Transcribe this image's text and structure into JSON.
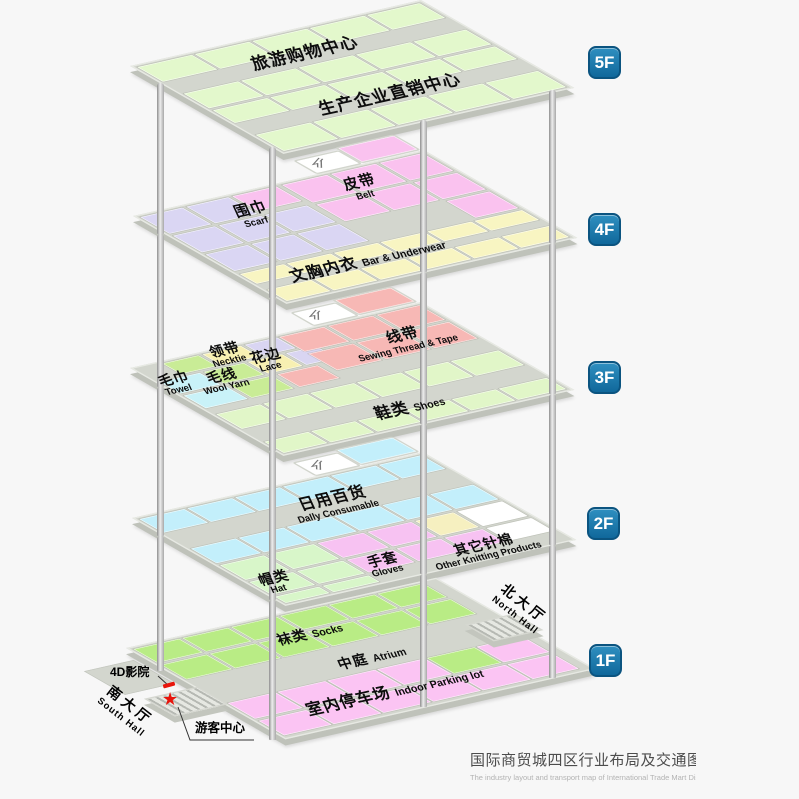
{
  "title": {
    "zh": "国际商贸城四区行业布局及交通图",
    "en": "The industry layout and transport map of International Trade Mart District Four"
  },
  "palette": {
    "base": "#d3d6ce",
    "green5": "#e3f8cc",
    "scarf": "#dad6f3",
    "belt": "#fac2ef",
    "bra": "#f8f5c2",
    "towel": "#c9f2f8",
    "necktie": "#f7f0b2",
    "wool": "#c9ec96",
    "lace": "#d9d5f2",
    "sewing": "#f7b8b5",
    "shoes": "#e1f6c8",
    "daily": "#c3effb",
    "hat": "#d8f6c9",
    "gloves": "#f7c2f2",
    "knitw": "#ffffff",
    "knity": "#f6f0c0",
    "socks": "#b9ec85",
    "parking": "#fbc4f3",
    "white": "#ffffff",
    "badge_blue": "#1879ae",
    "marker_red": "#e8150c"
  },
  "floor_badges": [
    {
      "label": "5F",
      "x": 588,
      "y": 46
    },
    {
      "label": "4F",
      "x": 588,
      "y": 213
    },
    {
      "label": "3F",
      "x": 588,
      "y": 361
    },
    {
      "label": "2F",
      "x": 587,
      "y": 507
    },
    {
      "label": "1F",
      "x": 589,
      "y": 644
    }
  ],
  "floors": [
    {
      "id": "5f",
      "anchor": [
        130,
        66
      ],
      "size": [
        300,
        175
      ],
      "tiles": [
        [
          2,
          2,
          57,
          30,
          "green5"
        ],
        [
          62,
          2,
          57,
          30,
          "green5"
        ],
        [
          122,
          2,
          57,
          30,
          "green5"
        ],
        [
          182,
          2,
          57,
          30,
          "green5"
        ],
        [
          242,
          2,
          55,
          30,
          "green5"
        ],
        [
          2,
          56,
          57,
          30,
          "green5"
        ],
        [
          62,
          56,
          57,
          30,
          "green5"
        ],
        [
          122,
          56,
          57,
          30,
          "green5"
        ],
        [
          182,
          56,
          57,
          30,
          "green5"
        ],
        [
          242,
          56,
          55,
          30,
          "green5"
        ],
        [
          2,
          90,
          57,
          26,
          "green5"
        ],
        [
          62,
          90,
          57,
          26,
          "green5"
        ],
        [
          122,
          90,
          57,
          26,
          "green5"
        ],
        [
          182,
          90,
          57,
          26,
          "green5"
        ],
        [
          242,
          90,
          55,
          26,
          "green5"
        ],
        [
          2,
          140,
          57,
          33,
          "green5"
        ],
        [
          62,
          140,
          57,
          33,
          "green5"
        ],
        [
          122,
          140,
          57,
          33,
          "green5"
        ],
        [
          182,
          140,
          57,
          33,
          "green5"
        ],
        [
          242,
          140,
          55,
          33,
          "green5"
        ]
      ]
    },
    {
      "id": "4f",
      "anchor": [
        133,
        216
      ],
      "size": [
        300,
        175
      ],
      "tiles": [
        [
          2,
          2,
          44,
          34,
          "scarf"
        ],
        [
          50,
          2,
          44,
          34,
          "scarf"
        ],
        [
          2,
          40,
          44,
          34,
          "scarf"
        ],
        [
          50,
          40,
          44,
          34,
          "scarf"
        ],
        [
          98,
          40,
          44,
          34,
          "scarf"
        ],
        [
          2,
          78,
          44,
          34,
          "scarf"
        ],
        [
          50,
          78,
          44,
          34,
          "scarf"
        ],
        [
          98,
          78,
          44,
          34,
          "scarf"
        ],
        [
          98,
          2,
          46,
          30,
          "belt"
        ],
        [
          150,
          2,
          47,
          36,
          "belt"
        ],
        [
          201,
          2,
          47,
          36,
          "belt"
        ],
        [
          252,
          2,
          45,
          36,
          "belt"
        ],
        [
          150,
          42,
          47,
          34,
          "belt"
        ],
        [
          201,
          42,
          47,
          34,
          "belt"
        ],
        [
          252,
          42,
          45,
          34,
          "belt"
        ],
        [
          252,
          80,
          45,
          34,
          "belt"
        ],
        [
          2,
          118,
          46,
          20,
          "bra"
        ],
        [
          51,
          118,
          46,
          20,
          "bra"
        ],
        [
          100,
          118,
          46,
          20,
          "bra"
        ],
        [
          149,
          118,
          46,
          20,
          "bra"
        ],
        [
          198,
          118,
          46,
          20,
          "bra"
        ],
        [
          247,
          118,
          50,
          20,
          "bra"
        ],
        [
          2,
          150,
          46,
          23,
          "bra"
        ],
        [
          51,
          150,
          46,
          23,
          "bra"
        ],
        [
          100,
          150,
          46,
          23,
          "bra"
        ],
        [
          149,
          150,
          46,
          23,
          "bra"
        ],
        [
          198,
          150,
          46,
          23,
          "bra"
        ],
        [
          247,
          150,
          50,
          23,
          "bra"
        ]
      ],
      "entrance": {
        "white": [
          192,
          -28,
          44,
          24
        ],
        "color": [
          240,
          -33,
          58,
          28
        ],
        "colorKey": "belt",
        "arrow": [
          198,
          -26
        ]
      }
    },
    {
      "id": "3f",
      "anchor": [
        130,
        368
      ],
      "size": [
        300,
        175
      ],
      "tiles": [
        [
          28,
          2,
          38,
          22,
          "wool"
        ],
        [
          70,
          2,
          40,
          22,
          "necktie"
        ],
        [
          114,
          2,
          34,
          22,
          "lace"
        ],
        [
          2,
          28,
          42,
          24,
          "towel"
        ],
        [
          48,
          28,
          42,
          24,
          "wool"
        ],
        [
          94,
          28,
          36,
          24,
          "necktie"
        ],
        [
          134,
          28,
          32,
          24,
          "lace"
        ],
        [
          2,
          56,
          44,
          26,
          "towel"
        ],
        [
          50,
          56,
          44,
          26,
          "wool"
        ],
        [
          100,
          56,
          42,
          26,
          "sewing"
        ],
        [
          150,
          2,
          47,
          30,
          "sewing"
        ],
        [
          201,
          2,
          47,
          30,
          "sewing"
        ],
        [
          252,
          2,
          45,
          30,
          "sewing"
        ],
        [
          150,
          36,
          47,
          34,
          "sewing"
        ],
        [
          201,
          36,
          47,
          34,
          "sewing"
        ],
        [
          252,
          36,
          45,
          34,
          "sewing"
        ],
        [
          2,
          94,
          46,
          30,
          "shoes"
        ],
        [
          51,
          94,
          46,
          30,
          "shoes"
        ],
        [
          100,
          94,
          46,
          30,
          "shoes"
        ],
        [
          149,
          94,
          46,
          30,
          "shoes"
        ],
        [
          198,
          94,
          46,
          30,
          "shoes"
        ],
        [
          247,
          94,
          50,
          30,
          "shoes"
        ],
        [
          2,
          150,
          46,
          23,
          "shoes"
        ],
        [
          51,
          150,
          46,
          23,
          "shoes"
        ],
        [
          100,
          150,
          46,
          23,
          "shoes"
        ],
        [
          149,
          150,
          46,
          23,
          "shoes"
        ],
        [
          198,
          150,
          46,
          23,
          "shoes"
        ],
        [
          247,
          150,
          50,
          23,
          "shoes"
        ]
      ],
      "entrance": {
        "white": [
          192,
          -28,
          44,
          24
        ],
        "color": [
          240,
          -33,
          58,
          28
        ],
        "colorKey": "sewing",
        "arrow": [
          198,
          -26
        ]
      }
    },
    {
      "id": "2f",
      "anchor": [
        132,
        518
      ],
      "size": [
        300,
        175
      ],
      "tiles": [
        [
          2,
          2,
          47,
          28,
          "daily"
        ],
        [
          52,
          2,
          47,
          28,
          "daily"
        ],
        [
          102,
          2,
          47,
          28,
          "daily"
        ],
        [
          152,
          2,
          47,
          28,
          "daily"
        ],
        [
          202,
          2,
          47,
          28,
          "daily"
        ],
        [
          252,
          2,
          45,
          28,
          "daily"
        ],
        [
          2,
          62,
          47,
          30,
          "daily"
        ],
        [
          52,
          62,
          47,
          30,
          "daily"
        ],
        [
          102,
          62,
          47,
          30,
          "daily"
        ],
        [
          152,
          62,
          47,
          30,
          "daily"
        ],
        [
          202,
          62,
          47,
          30,
          "daily"
        ],
        [
          252,
          62,
          45,
          30,
          "daily"
        ],
        [
          2,
          96,
          46,
          30,
          "hat"
        ],
        [
          52,
          96,
          48,
          30,
          "hat"
        ],
        [
          2,
          130,
          46,
          26,
          "hat"
        ],
        [
          52,
          130,
          48,
          26,
          "hat"
        ],
        [
          2,
          160,
          46,
          13,
          "hat"
        ],
        [
          52,
          160,
          48,
          13,
          "hat"
        ],
        [
          104,
          96,
          48,
          30,
          "gloves"
        ],
        [
          156,
          96,
          46,
          30,
          "gloves"
        ],
        [
          104,
          130,
          48,
          26,
          "gloves"
        ],
        [
          156,
          130,
          46,
          26,
          "gloves"
        ],
        [
          206,
          130,
          40,
          26,
          "gloves"
        ],
        [
          206,
          96,
          40,
          30,
          "knity"
        ],
        [
          250,
          96,
          47,
          30,
          "knitw"
        ],
        [
          250,
          130,
          47,
          26,
          "knitw"
        ]
      ],
      "entrance": {
        "white": [
          192,
          -28,
          44,
          24
        ],
        "color": [
          240,
          -33,
          58,
          28
        ],
        "colorKey": "daily",
        "arrow": [
          198,
          -26
        ]
      }
    },
    {
      "id": "1f",
      "anchor": [
        126,
        648
      ],
      "size": [
        320,
        182
      ],
      "tiles": [
        [
          2,
          2,
          48,
          28,
          "socks"
        ],
        [
          53,
          2,
          48,
          28,
          "socks"
        ],
        [
          104,
          2,
          48,
          28,
          "socks"
        ],
        [
          155,
          2,
          48,
          28,
          "socks"
        ],
        [
          206,
          2,
          48,
          28,
          "socks"
        ],
        [
          257,
          2,
          48,
          28,
          "socks"
        ],
        [
          2,
          34,
          48,
          30,
          "socks"
        ],
        [
          53,
          34,
          48,
          30,
          "socks"
        ],
        [
          104,
          34,
          48,
          30,
          "socks"
        ],
        [
          155,
          34,
          48,
          30,
          "socks"
        ],
        [
          206,
          34,
          48,
          30,
          "socks"
        ],
        [
          257,
          34,
          48,
          30,
          "socks"
        ],
        [
          2,
          112,
          50,
          32,
          "parking"
        ],
        [
          54,
          112,
          50,
          32,
          "parking"
        ],
        [
          106,
          112,
          50,
          32,
          "parking"
        ],
        [
          158,
          112,
          50,
          32,
          "parking"
        ],
        [
          210,
          112,
          50,
          32,
          "socks"
        ],
        [
          262,
          112,
          48,
          32,
          "parking"
        ],
        [
          2,
          148,
          50,
          30,
          "parking"
        ],
        [
          54,
          148,
          50,
          30,
          "parking"
        ],
        [
          106,
          148,
          50,
          30,
          "parking"
        ],
        [
          158,
          148,
          50,
          30,
          "parking"
        ],
        [
          210,
          148,
          50,
          30,
          "parking"
        ],
        [
          262,
          148,
          48,
          30,
          "parking"
        ]
      ],
      "ramps": [
        {
          "id": "north-hall-ramp",
          "rect": [
            282,
            76,
            48,
            30
          ]
        },
        {
          "id": "south-hall-ramp",
          "rect": [
            -55,
            78,
            52,
            32
          ]
        }
      ],
      "strips": [
        [
          -64,
          18,
          50,
          46
        ]
      ]
    }
  ],
  "area_labels": [
    {
      "id": "tourism-shopping-center",
      "zh": "旅游购物中心",
      "en": "",
      "x": 305,
      "y": 54,
      "zhSize": 17,
      "layout": "stack"
    },
    {
      "id": "factory-direct-center",
      "zh": "生产企业直销中心",
      "en": "",
      "x": 390,
      "y": 95,
      "zhSize": 17,
      "layout": "stack"
    },
    {
      "id": "belt",
      "zh": "皮带",
      "en": "Belt",
      "x": 362,
      "y": 188,
      "zhSize": 15,
      "layout": "stack"
    },
    {
      "id": "scarf",
      "zh": "围巾",
      "en": "Scarf",
      "x": 253,
      "y": 215,
      "zhSize": 15,
      "layout": "stack"
    },
    {
      "id": "bra-underwear",
      "zh": "文胸内衣",
      "en": "Bar & Underwear",
      "x": 368,
      "y": 261,
      "zhSize": 16,
      "layout": "inline"
    },
    {
      "id": "sewing-thread-tape",
      "zh": "线带",
      "en": "Sewing Thread & Tape",
      "x": 405,
      "y": 341,
      "zhSize": 15,
      "layout": "stack"
    },
    {
      "id": "towel",
      "zh": "毛巾",
      "en": "Towel",
      "x": 176,
      "y": 384,
      "zhSize": 14,
      "layout": "stack"
    },
    {
      "id": "necktie",
      "zh": "领带",
      "en": "Necktie",
      "x": 227,
      "y": 355,
      "zhSize": 14,
      "layout": "stack"
    },
    {
      "id": "wool-yarn",
      "zh": "毛线",
      "en": "Wool Yarn",
      "x": 224,
      "y": 381,
      "zhSize": 14,
      "layout": "stack"
    },
    {
      "id": "lace",
      "zh": "花边",
      "en": "Lace",
      "x": 268,
      "y": 361,
      "zhSize": 14,
      "layout": "stack"
    },
    {
      "id": "shoes",
      "zh": "鞋类",
      "en": "Shoes",
      "x": 410,
      "y": 408,
      "zhSize": 16,
      "layout": "inline"
    },
    {
      "id": "daily-consumable",
      "zh": "日用百货",
      "en": "Dally Consumable",
      "x": 335,
      "y": 504,
      "zhSize": 16,
      "layout": "stack"
    },
    {
      "id": "hat",
      "zh": "帽类",
      "en": "Hat",
      "x": 276,
      "y": 583,
      "zhSize": 14,
      "layout": "stack"
    },
    {
      "id": "gloves",
      "zh": "手套",
      "en": "Gloves",
      "x": 385,
      "y": 565,
      "zhSize": 14,
      "layout": "stack"
    },
    {
      "id": "other-knitting",
      "zh": "其它针棉",
      "en": "Other Knitting Products",
      "x": 486,
      "y": 550,
      "zhSize": 14,
      "layout": "stack"
    },
    {
      "id": "socks",
      "zh": "袜类",
      "en": "Socks",
      "x": 310,
      "y": 634,
      "zhSize": 14,
      "layout": "inline"
    },
    {
      "id": "atrium",
      "zh": "中庭",
      "en": "Atrium",
      "x": 372,
      "y": 658,
      "zhSize": 14,
      "layout": "inline"
    },
    {
      "id": "indoor-parking",
      "zh": "室内停车场",
      "en": "Indoor Parking lot",
      "x": 395,
      "y": 692,
      "zhSize": 16,
      "layout": "inline"
    }
  ],
  "annotations": {
    "cinema": {
      "label": "4D影院"
    },
    "visitor": {
      "label": "游客中心"
    },
    "south_hall": {
      "zh": "南大厅",
      "en": "South Hall"
    },
    "north_hall": {
      "zh": "北大厅",
      "en": "North Hall"
    }
  },
  "pillars": [
    {
      "x": 160,
      "segments": [
        [
          83,
          234
        ],
        [
          234,
          387
        ],
        [
          387,
          536
        ],
        [
          536,
          671
        ]
      ]
    },
    {
      "x": 272,
      "segments": [
        [
          147,
          298
        ],
        [
          298,
          451
        ],
        [
          451,
          600
        ],
        [
          600,
          740
        ]
      ]
    },
    {
      "x": 423,
      "segments": [
        [
          120,
          272
        ],
        [
          272,
          424
        ],
        [
          424,
          574
        ],
        [
          574,
          707
        ]
      ]
    },
    {
      "x": 552,
      "segments": [
        [
          90,
          243
        ],
        [
          243,
          394
        ],
        [
          394,
          545
        ],
        [
          545,
          678
        ]
      ]
    }
  ]
}
